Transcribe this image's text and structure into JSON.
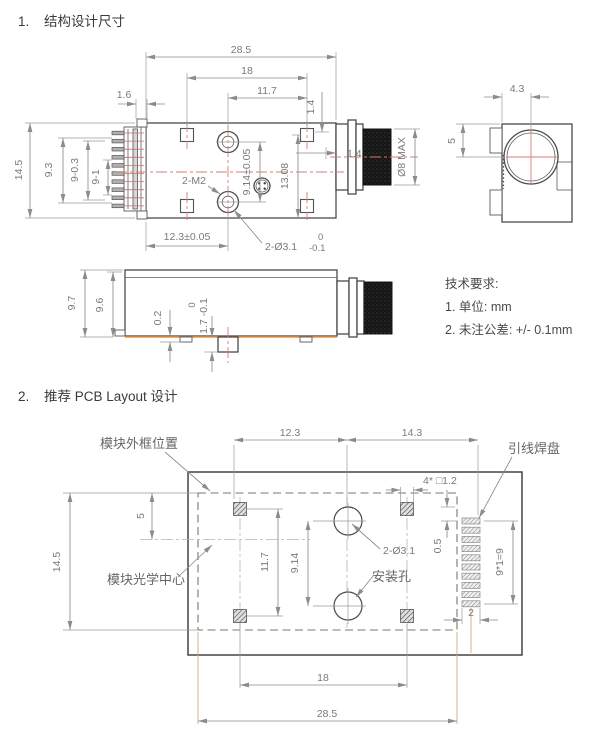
{
  "sections": {
    "s1_num": "1.",
    "s1_title": "结构设计尺寸",
    "s2_num": "2.",
    "s2_title": "推荐 PCB Layout 设计"
  },
  "top_view": {
    "dim_total": "28.5",
    "dim_mount_span": "18",
    "dim_hole_to_pad": "11.7",
    "dim_pin_protrude": "1.6",
    "dim_pad_top": "1.4",
    "dim_pad_side": "1.4",
    "dim_height": "14.5",
    "dim_pin_span": "9.3",
    "dim_pin_row": "9-0.3",
    "dim_pin_pitch": "9-1",
    "label_screws": "2-M2",
    "dim_hole_pitch": "9.14±0.05",
    "dim_pad_vspan": "13.08",
    "dim_hole_offset": "12.3±0.05",
    "hole_tol_top": "0",
    "label_holes": "2-Ø3.1",
    "hole_tol_bot": "-0.1",
    "dim_lens": "Ø8 MAX"
  },
  "end_view": {
    "dim_lens_x": "4.3",
    "dim_lens_y": "5"
  },
  "side_view": {
    "dim_height_total": "9.7",
    "dim_height_body": "9.6",
    "dim_foot": "0.2",
    "tab_tol_top": "0",
    "tab_dim": "1.7 -0.1"
  },
  "tech_notes": {
    "title": "技术要求:",
    "note1": "1. 单位: mm",
    "note2": "2. 未注公差: +/- 0.1mm"
  },
  "pcb_view": {
    "dim_left": "12.3",
    "dim_right": "14.3",
    "label_frame": "模块外框位置",
    "label_lead_pads": "引线焊盘",
    "label_pad_size": "4* □1.2",
    "dim_center_y": "5",
    "dim_height": "14.5",
    "dim_pad_vspan": "11.7",
    "dim_hole_pitch": "9.14",
    "label_holes": "2-Ø3.1",
    "label_mount": "安装孔",
    "label_optical": "模块光学中心",
    "dim_pad_gap": "0.5",
    "dim_pitch": "9*1=9",
    "dim_pad_w": "2",
    "dim_pad_span": "18",
    "dim_total": "28.5"
  },
  "colors": {
    "centerline_red": "#d97b74",
    "extension_tan": "#cfa87b",
    "bottom_orange": "#ef9643",
    "line_dark": "#4a4a4a",
    "dim_gray": "#8c8c8c"
  }
}
